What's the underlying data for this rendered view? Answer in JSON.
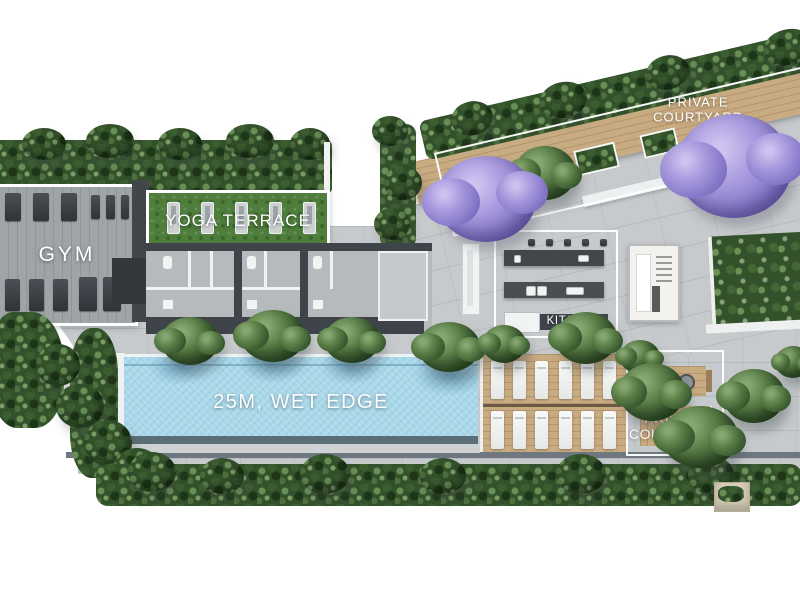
{
  "plan": {
    "areas": {
      "gym": {
        "label": "GYM"
      },
      "yoga_terrace": {
        "label": "YOGA TERRACE"
      },
      "kitchen": {
        "label": "KITCHEN"
      },
      "pool": {
        "label": "25M, WET EDGE"
      },
      "private_courtyard_top": {
        "label_line1": "PRIVATE",
        "label_line2": "COURTYARD"
      },
      "private_courtyard_bottom": {
        "label_line1": "PRIVATE",
        "label_line2": "COURTYARD"
      }
    },
    "colors": {
      "paving": "#c7cacc",
      "pool_water": "#aad8e9",
      "wood_deck": "#c9ab82",
      "hedge_green": "#33512b",
      "grass": "#4e7d3c",
      "jacaranda_purple": "#a99bde",
      "outline_white": "#ffffff",
      "counter_dark": "#43474c"
    }
  }
}
